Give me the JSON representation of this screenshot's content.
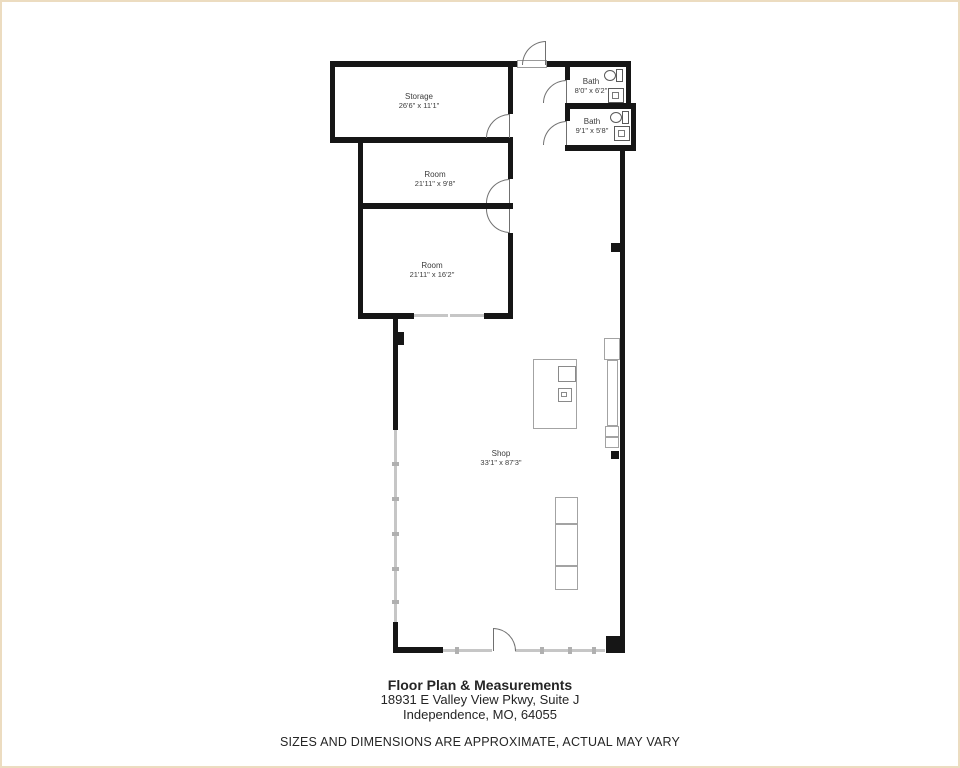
{
  "plan": {
    "rooms": {
      "storage": {
        "name": "Storage",
        "dims": "26'6\" x 11'1\""
      },
      "room1": {
        "name": "Room",
        "dims": "21'11\" x 9'8\""
      },
      "room2": {
        "name": "Room",
        "dims": "21'11\" x 16'2\""
      },
      "bath1": {
        "name": "Bath",
        "dims": "8'0\" x 6'2\""
      },
      "bath2": {
        "name": "Bath",
        "dims": "9'1\" x 5'8\""
      },
      "shop": {
        "name": "Shop",
        "dims": "33'1\" x 87'3\""
      }
    }
  },
  "footer": {
    "title": "Floor Plan & Measurements",
    "address_line1": "18931 E Valley View Pkwy, Suite J",
    "address_line2": "Independence, MO, 64055",
    "disclaimer": "SIZES AND DIMENSIONS ARE APPROXIMATE, ACTUAL MAY VARY"
  },
  "colors": {
    "wall": "#161616",
    "storefront": "#c6c6c6",
    "furniture_outline": "#a3a3a3",
    "door_arc": "#707070",
    "text": "#3c3c3c"
  }
}
